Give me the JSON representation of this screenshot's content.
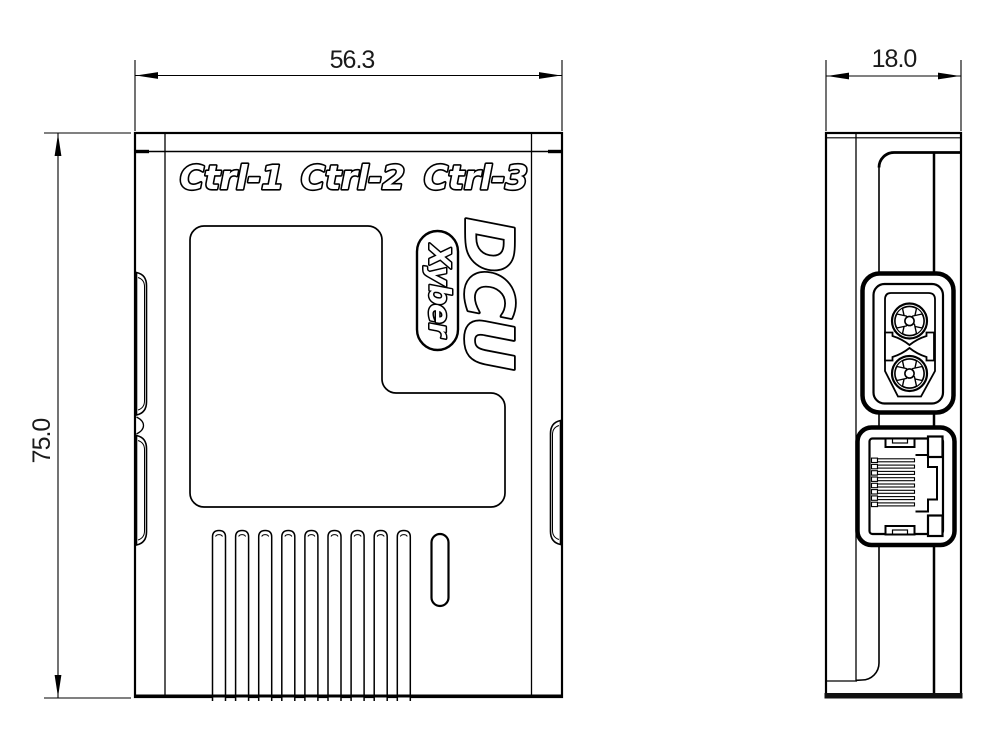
{
  "drawing": {
    "background": "#ffffff",
    "line_color": "#000000",
    "front_view": {
      "width_dim": "56.3",
      "height_dim": "75.0",
      "port_labels": [
        "Ctrl-1",
        "Ctrl-2",
        "Ctrl-3"
      ],
      "model_logo": "DCU",
      "brand_badge": "Xyber",
      "vent_slot_count": 9
    },
    "side_view": {
      "depth_dim": "18.0",
      "features": [
        "power-connector",
        "ethernet-port"
      ]
    }
  }
}
